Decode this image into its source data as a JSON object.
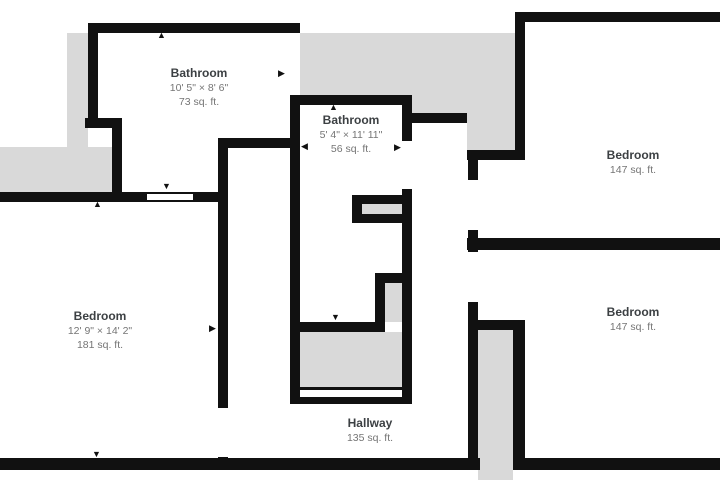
{
  "floor_plan": {
    "rooms": [
      {
        "name": "Bathroom",
        "dimensions": "10' 5\" × 8' 6\"",
        "area": "73 sq. ft."
      },
      {
        "name": "Bathroom",
        "dimensions": "5' 4\" × 11' 11\"",
        "area": "56 sq. ft."
      },
      {
        "name": "Bedroom",
        "dimensions": "",
        "area": "147 sq. ft."
      },
      {
        "name": "Bedroom",
        "dimensions": "12' 9\" × 14' 2\"",
        "area": "181 sq. ft."
      },
      {
        "name": "Bedroom",
        "dimensions": "",
        "area": "147 sq. ft."
      },
      {
        "name": "Hallway",
        "dimensions": "",
        "area": "135 sq. ft."
      }
    ],
    "icons": {
      "up_arrow": "▲",
      "down_arrow": "▼",
      "left_arrow": "◀",
      "right_arrow": "▶"
    },
    "colors": {
      "wall": "#111111",
      "excluded_area": "#d9d9d9",
      "room_fill": "#ffffff",
      "room_name_text": "#3c4043",
      "room_detail_text": "#757575"
    }
  }
}
